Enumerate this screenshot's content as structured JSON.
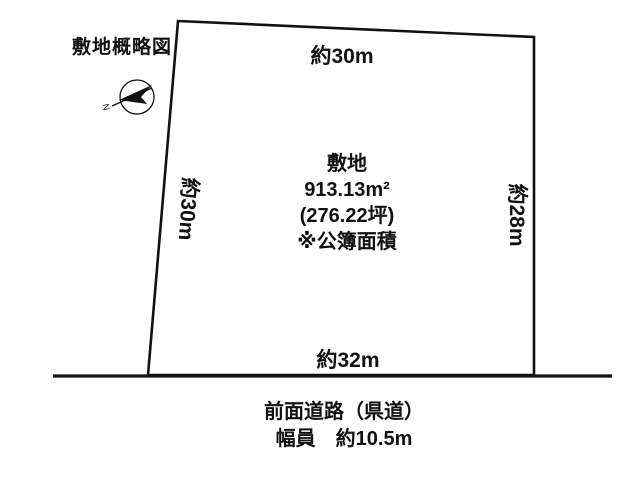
{
  "title": "敷地概略図",
  "colors": {
    "ink": "#111111",
    "background": "#ffffff"
  },
  "compass": {
    "icon": "north-arrow-icon",
    "label": "N"
  },
  "site": {
    "label": "敷地",
    "area_m2": "913.13m²",
    "area_tsubo": "(276.22坪)",
    "area_note": "※公簿面積",
    "dim_top": "約30m",
    "dim_left": "約30m",
    "dim_right": "約28m",
    "dim_bottom": "約32m"
  },
  "road": {
    "name": "前面道路（県道）",
    "width": "幅員　約10.5m"
  }
}
